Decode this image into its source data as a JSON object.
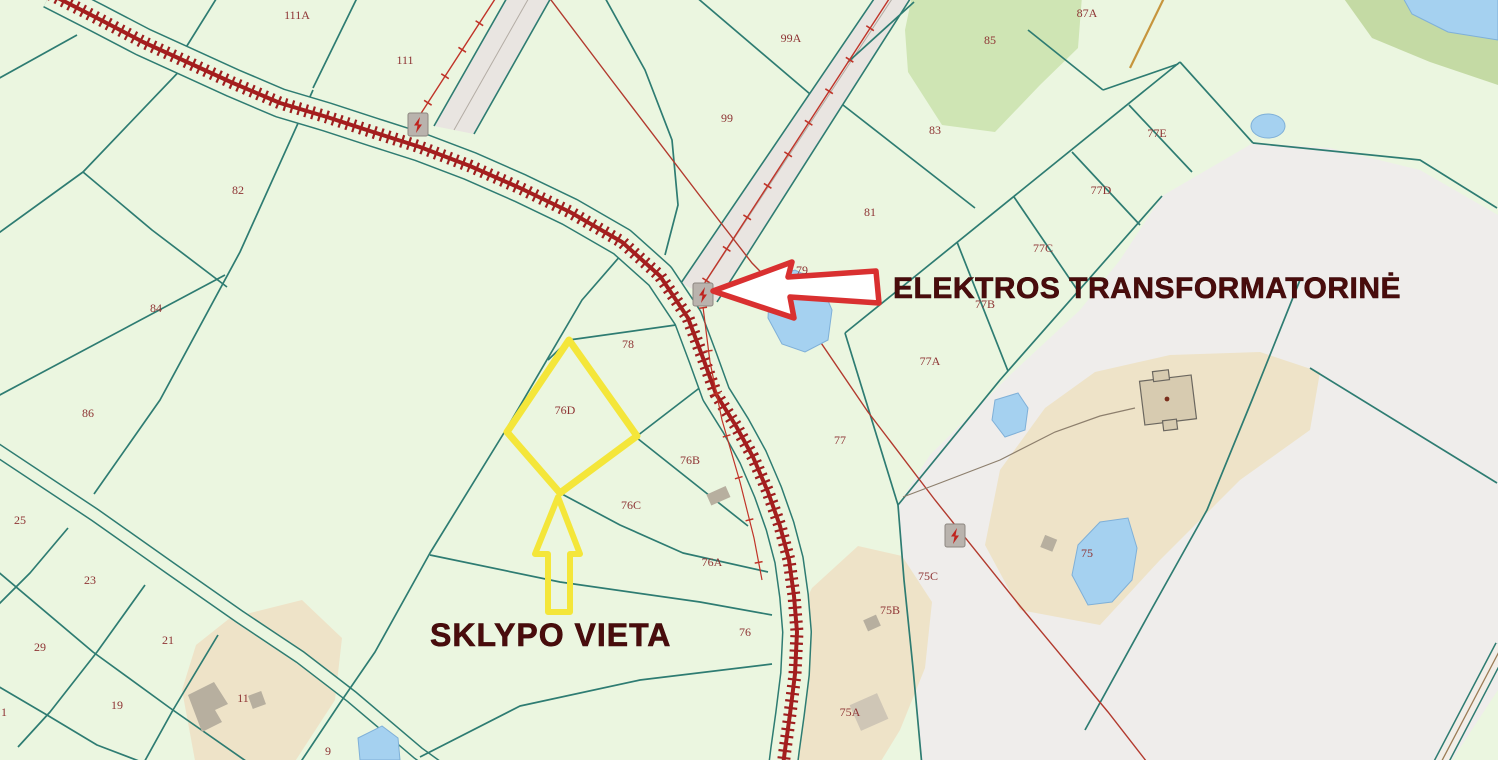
{
  "map": {
    "annotations": {
      "plot_location_label": "SKLYPO VIETA",
      "transformer_label": "ELEKTROS TRANSFORMATORINĖ"
    },
    "parcel_labels": [
      {
        "id": "111A",
        "x": 297,
        "y": 19
      },
      {
        "id": "111",
        "x": 405,
        "y": 64
      },
      {
        "id": "99A",
        "x": 791,
        "y": 42
      },
      {
        "id": "99",
        "x": 727,
        "y": 122
      },
      {
        "id": "87A",
        "x": 1087,
        "y": 17
      },
      {
        "id": "85",
        "x": 990,
        "y": 44
      },
      {
        "id": "83",
        "x": 935,
        "y": 134
      },
      {
        "id": "81",
        "x": 870,
        "y": 216
      },
      {
        "id": "82",
        "x": 238,
        "y": 194
      },
      {
        "id": "84",
        "x": 156,
        "y": 312
      },
      {
        "id": "86",
        "x": 88,
        "y": 417
      },
      {
        "id": "77E",
        "x": 1157,
        "y": 137
      },
      {
        "id": "77D",
        "x": 1101,
        "y": 194
      },
      {
        "id": "77C",
        "x": 1043,
        "y": 252
      },
      {
        "id": "77B",
        "x": 985,
        "y": 308
      },
      {
        "id": "77A",
        "x": 930,
        "y": 365
      },
      {
        "id": "79",
        "x": 802,
        "y": 274
      },
      {
        "id": "78",
        "x": 628,
        "y": 348
      },
      {
        "id": "76D",
        "x": 565,
        "y": 414
      },
      {
        "id": "76B",
        "x": 690,
        "y": 464
      },
      {
        "id": "76C",
        "x": 631,
        "y": 509
      },
      {
        "id": "76A",
        "x": 712,
        "y": 566
      },
      {
        "id": "76",
        "x": 745,
        "y": 636
      },
      {
        "id": "77",
        "x": 840,
        "y": 444
      },
      {
        "id": "75C",
        "x": 928,
        "y": 580
      },
      {
        "id": "75B",
        "x": 890,
        "y": 614
      },
      {
        "id": "75A",
        "x": 850,
        "y": 716
      },
      {
        "id": "75",
        "x": 1087,
        "y": 557
      },
      {
        "id": "25",
        "x": 20,
        "y": 524
      },
      {
        "id": "23",
        "x": 90,
        "y": 584
      },
      {
        "id": "29",
        "x": 40,
        "y": 651
      },
      {
        "id": "21",
        "x": 168,
        "y": 644
      },
      {
        "id": "19",
        "x": 117,
        "y": 709
      },
      {
        "id": "11",
        "x": 243,
        "y": 702
      },
      {
        "id": "9",
        "x": 328,
        "y": 755
      },
      {
        "id": "1",
        "x": 4,
        "y": 716
      }
    ],
    "icons": [
      {
        "name": "transformer-icon",
        "x": 418,
        "y": 125
      },
      {
        "name": "transformer-icon",
        "x": 703,
        "y": 295
      },
      {
        "name": "transformer-icon",
        "x": 955,
        "y": 536
      }
    ],
    "colors": {
      "background": "#ebf6e0",
      "parcel_line": "#2e7c72",
      "railway_red": "#9e1e1e",
      "water_blue": "#a5d1f0",
      "forest_green": "#cfe5b4",
      "land_use_gray": "#efedeb",
      "homestead_beige": "#eee3c8",
      "building_gray": "#b7af9f",
      "highlight_yellow": "#f4e63a",
      "annotation_arrow_red": "#d93030",
      "annotation_text": "#490c0c",
      "parcel_label_text": "#8e3434",
      "power_line_red": "#c03328",
      "orange_line": "#c6953d"
    }
  }
}
